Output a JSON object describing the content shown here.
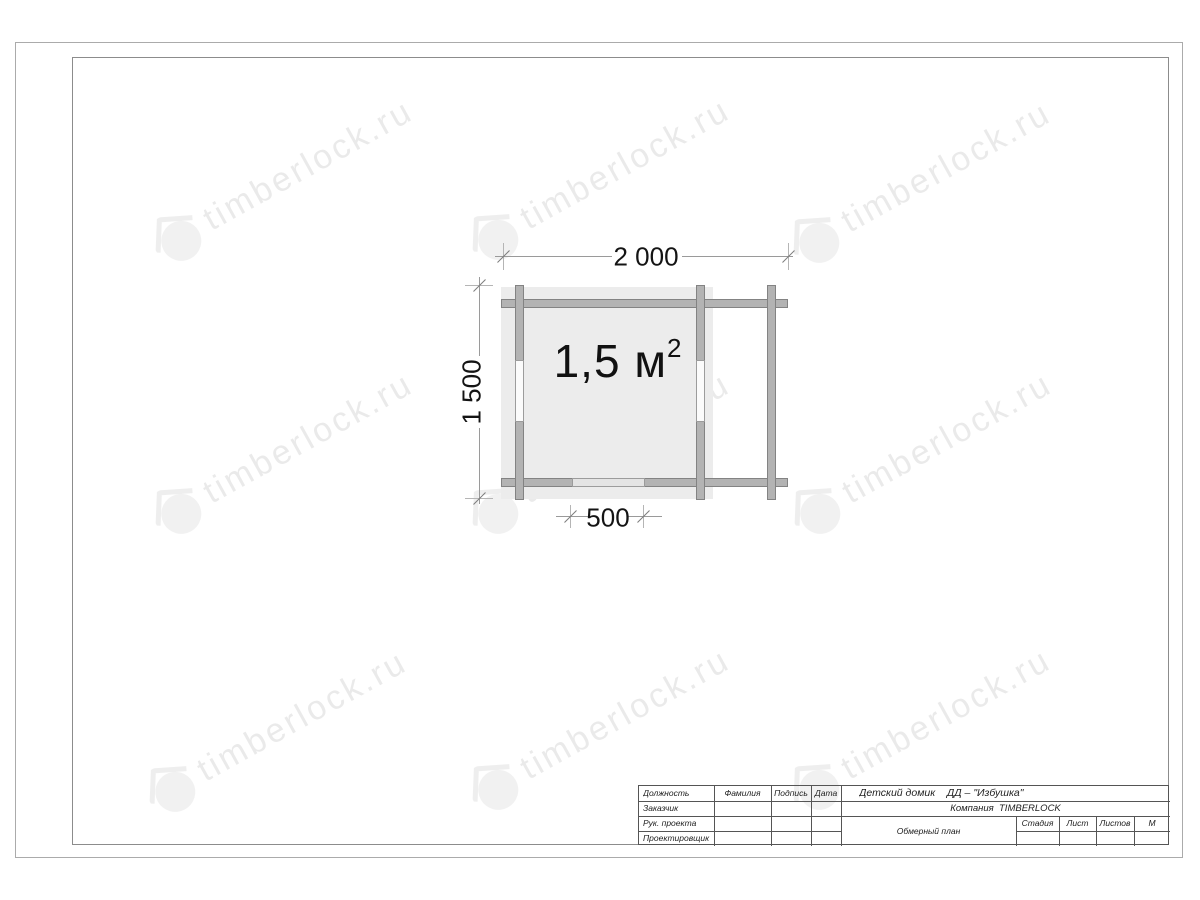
{
  "watermark": {
    "text": "timberlock.ru"
  },
  "plan": {
    "width_dim": "2 000",
    "height_dim": "1 500",
    "door_dim": "500",
    "area_value": "1,5 м",
    "area_sup": "2"
  },
  "title_block": {
    "position_header": "Должность",
    "name_header": "Фамилия",
    "signature_header": "Подпись",
    "date_header": "Дата",
    "customer": "Заказчик",
    "project_manager": "Рук. проекта",
    "designer": "Проектировщик",
    "project_title": "Детский домик    ДД – \"Избушка\"",
    "company": "Компания  TIMBERLOCK",
    "drawing_name": "Обмерный план",
    "stage": "Стадия",
    "sheet": "Лист",
    "sheets": "Листов",
    "scale": "М"
  },
  "colors": {
    "log_fill": "#b3b3b3",
    "floor_fill": "#ececec",
    "watermark_gray": "#ececec"
  }
}
